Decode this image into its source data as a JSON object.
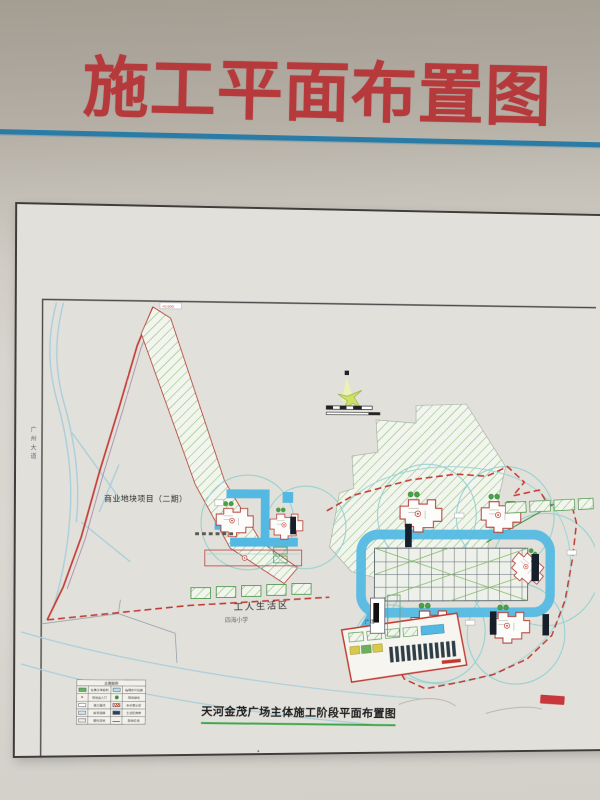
{
  "photo": {
    "wall_title": "施工平面布置图",
    "title_color": "#b63a3c",
    "divider_color": "#2a7ca6"
  },
  "drawing": {
    "caption": "天河金茂广场主体施工阶段平面布置图",
    "caption_underline_color": "#3fa84e",
    "labels": {
      "phase2_plot": "商业地块项目（二期）",
      "workers_living_area": "工人生活区",
      "school": "四海小学",
      "road_west": "广州大道",
      "plaza": "广场",
      "apex_elevation": "+0.000"
    },
    "legend": {
      "title": "主要图例",
      "rows": [
        {
          "left": "在建主体结构",
          "right": "临建办公设施"
        },
        {
          "left": "场地出入口",
          "right": "现场绿化"
        },
        {
          "left": "施工围挡",
          "right": "安全警示区"
        },
        {
          "left": "既有道路",
          "right": "生活区用房"
        },
        {
          "left": "硬化场地",
          "right": "用地红线"
        }
      ]
    },
    "colors": {
      "boundary_red": "#c23b34",
      "road_blue": "#54b9e2",
      "hatch_green": "#7cb661",
      "crane_circle_teal": "#8ecfcf",
      "river_blue": "#a9cedb",
      "grid_line": "#55606a"
    }
  }
}
